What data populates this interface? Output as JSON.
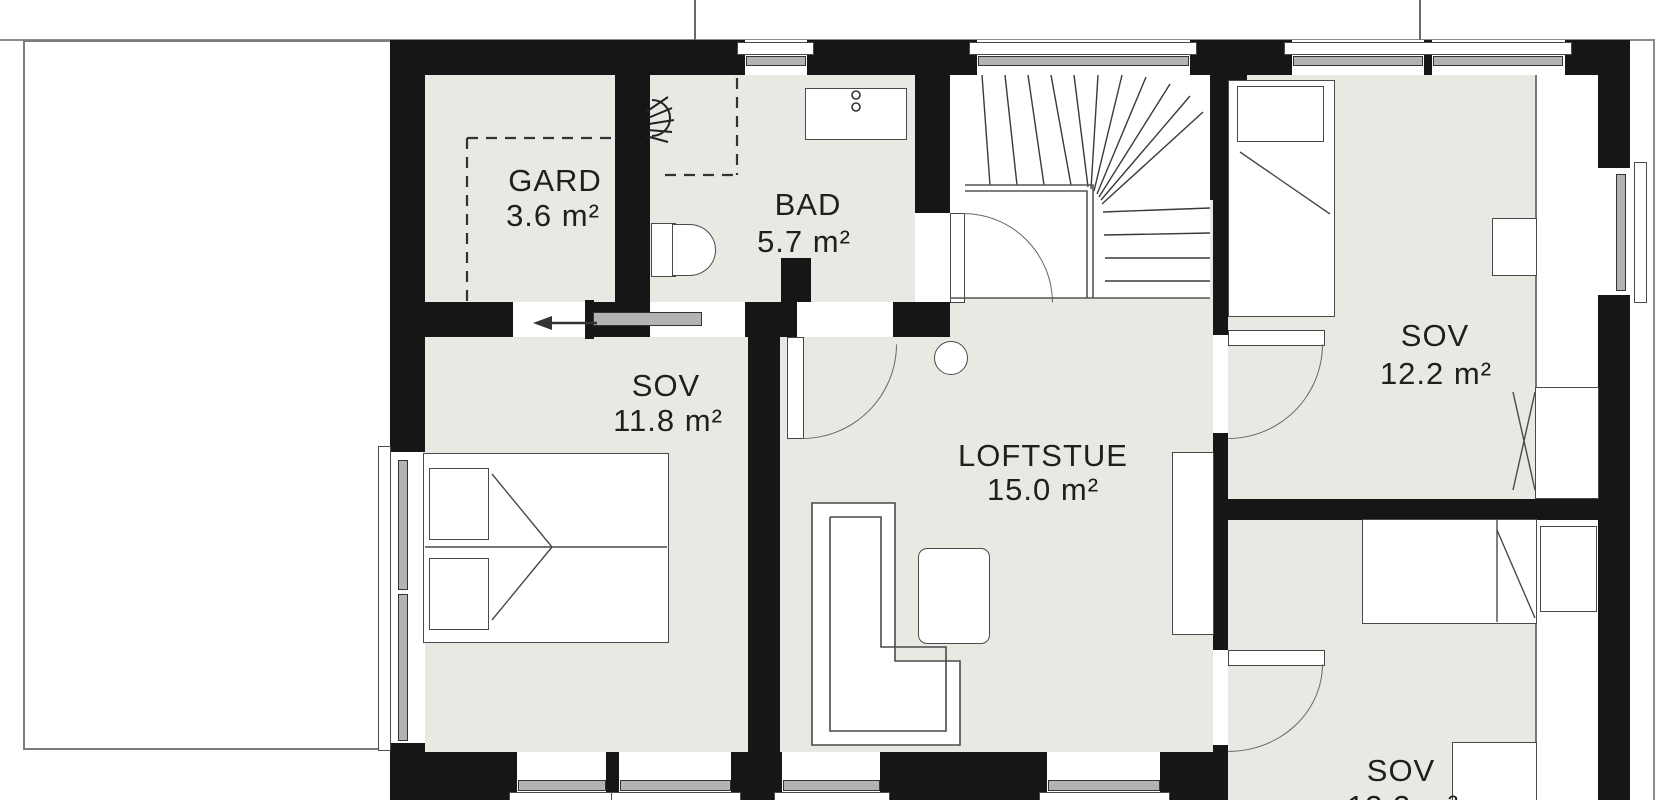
{
  "plan": {
    "type": "floor-plan",
    "language": "Norwegian",
    "rooms": {
      "gard": {
        "name": "GARD",
        "area": "3.6 m²"
      },
      "bad": {
        "name": "BAD",
        "area": "5.7 m²"
      },
      "sov1": {
        "name": "SOV",
        "area": "11.8 m²"
      },
      "loftstue": {
        "name": "LOFTSTUE",
        "area": "15.0 m²"
      },
      "sov2": {
        "name": "SOV",
        "area": "12.2 m²"
      },
      "sov3": {
        "name": "SOV",
        "area": "12.2 m²"
      }
    },
    "features": [
      "winder-staircase",
      "shower",
      "toilet",
      "vanity-sink",
      "double-bed",
      "single-beds",
      "corner-sofa",
      "ottoman",
      "desks",
      "wardrobe",
      "escape-arrow",
      "roof-outline-left",
      "low-ceiling-strip-right"
    ],
    "colors": {
      "wall": "#161616",
      "floor": "#e9e8e3",
      "outline": "#444444",
      "glazing": "#b3b3b3",
      "eave": "#8a8a8a"
    }
  }
}
